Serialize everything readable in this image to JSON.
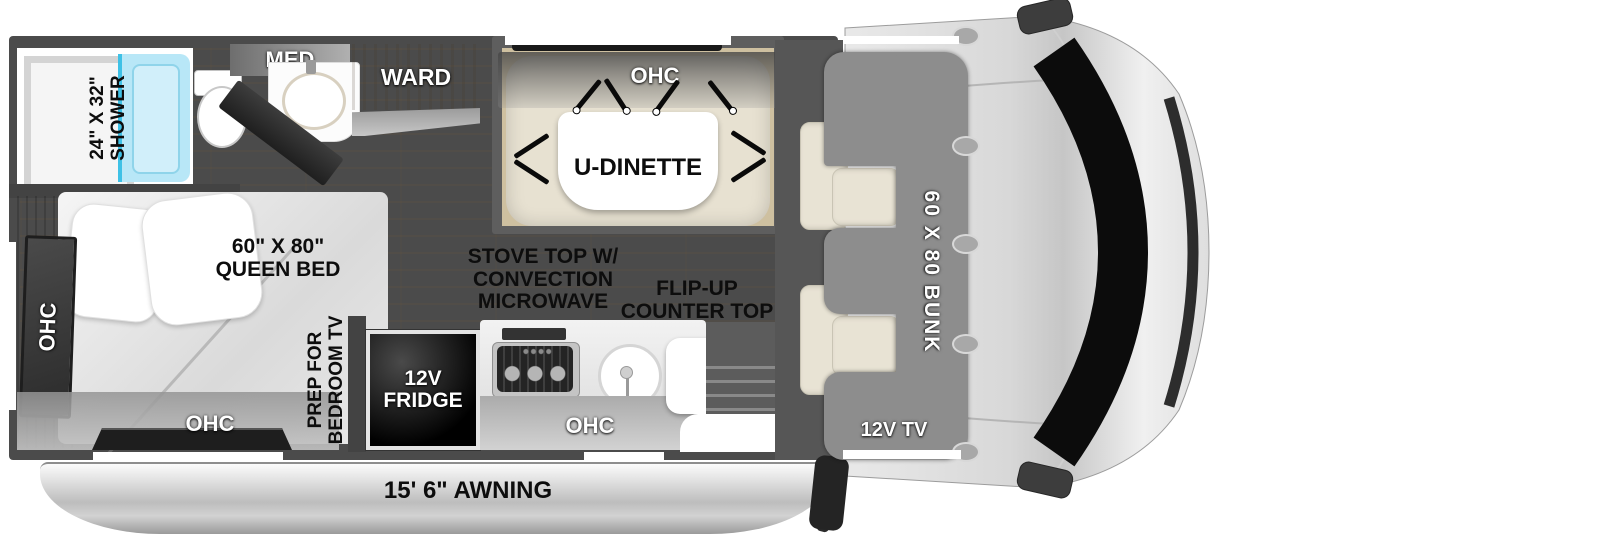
{
  "floorplan": {
    "bathroom": {
      "shower": {
        "line1": "24\" X 32\"",
        "line2": "SHOWER"
      },
      "med": "MED",
      "ward": "WARD"
    },
    "dinette": {
      "ohc": "OHC",
      "table": "U-DINETTE"
    },
    "bedroom": {
      "side_ohc": "OHC",
      "rear_ohc": "OHC",
      "bed": {
        "line1": "60\" X 80\"",
        "line2": "QUEEN BED"
      },
      "tv_prep": {
        "line1": "PREP FOR",
        "line2": "BEDROOM TV"
      }
    },
    "kitchen": {
      "stove": {
        "line1": "STOVE TOP W/",
        "line2": "CONVECTION",
        "line3": "MICROWAVE"
      },
      "flip_counter": {
        "line1": "FLIP-UP",
        "line2": "COUNTER TOP"
      },
      "fridge": {
        "line1": "12V",
        "line2": "FRIDGE"
      },
      "ohc": "OHC"
    },
    "cab": {
      "bunk": "60 X 80 BUNK",
      "tv": "12V TV"
    },
    "exterior": {
      "awning": "15' 6\" AWNING"
    },
    "colors": {
      "wall": "#4b4b4b",
      "wood_floor": "#d9c6a0",
      "shower_glass": "#b8e7f7",
      "shower_glass_edge": "#3ec1e6",
      "bench": "#e7e1d1",
      "bunk": "#8d8d8d",
      "awning": "#c2c2c2",
      "label_dark": "#0d0d0d",
      "label_light": "#ffffff"
    }
  }
}
